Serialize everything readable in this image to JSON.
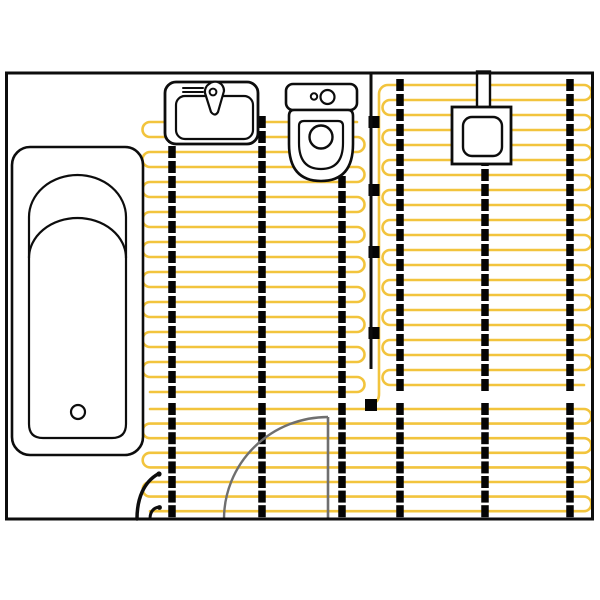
{
  "canvas": {
    "width": 600,
    "height": 600,
    "background": "#ffffff"
  },
  "colors": {
    "cable": "#F2C43D",
    "clip": "#050505",
    "outline": "#0d0d0d",
    "wall": "#0d0d0d",
    "door": "#6F6F6F",
    "fixture_fill": "#ffffff"
  },
  "room": {
    "x": 6.5,
    "y": 73,
    "w": 586,
    "h": 446,
    "stroke_width": 3
  },
  "heating": {
    "cable_stroke_width": 2.6,
    "zones": [
      {
        "name": "heating-zone-left",
        "x1": 150,
        "x2": 357,
        "y_top": 122,
        "spacing": 15,
        "rows": 19,
        "start_at_right": true,
        "prefix": ""
      },
      {
        "name": "heating-zone-right",
        "x1": 390,
        "x2": 584,
        "y_top": 85,
        "spacing": 15,
        "rows": 21,
        "start_at_right": false,
        "prefix": "M 372 404 Q 379 402 379 394 L 379 94 A 9 9 0 0 1 388 85"
      },
      {
        "name": "heating-zone-bottom",
        "x1": 150,
        "x2": 584,
        "y_top": 409,
        "spacing": 14.6,
        "rows": 8,
        "start_at_right": false,
        "prefix": ""
      }
    ],
    "strips": [
      {
        "x": 172,
        "zones": [
          "heating-zone-left",
          "heating-zone-bottom"
        ]
      },
      {
        "x": 262,
        "zones": [
          "heating-zone-left",
          "heating-zone-bottom"
        ]
      },
      {
        "x": 342,
        "zones": [
          "heating-zone-left",
          "heating-zone-bottom"
        ]
      },
      {
        "x": 400,
        "zones": [
          "heating-zone-right",
          "heating-zone-bottom"
        ]
      },
      {
        "x": 485,
        "zones": [
          "heating-zone-right",
          "heating-zone-bottom"
        ]
      },
      {
        "x": 570,
        "zones": [
          "heating-zone-right",
          "heating-zone-bottom"
        ]
      }
    ],
    "clip_size": {
      "w": 7.5,
      "h": 12
    },
    "feed_clips": {
      "x": 374,
      "w": 11,
      "h": 12,
      "ys": [
        122,
        190,
        252,
        333
      ]
    },
    "terminal": {
      "x": 365,
      "y": 399,
      "w": 12,
      "h": 12
    },
    "divider_line": {
      "x": 371,
      "y1": 73,
      "y2": 369,
      "stroke_width": 3
    },
    "leads": [
      {
        "name": "power-lead-main",
        "d": "M 137 519 C 137 498 144 482 158 474",
        "stroke_width": 3.5,
        "dot": {
          "cx": 159,
          "cy": 474,
          "r": 2.6
        }
      },
      {
        "name": "power-lead-small",
        "d": "M 150 519 C 150 512 153 508 159 507",
        "stroke_width": 3,
        "dot": {
          "cx": 159.5,
          "cy": 507.5,
          "r": 2.4
        }
      }
    ]
  },
  "fixtures": [
    {
      "name": "bathtub-outline",
      "type": "rect",
      "x": 12,
      "y": 147,
      "w": 131,
      "h": 308,
      "rx": 18,
      "sw": 2.6,
      "fill": true
    },
    {
      "name": "bathtub-basin",
      "type": "path",
      "d": "M 29 217 L 29 424 Q 29 438 43 438 L 112 438 Q 126 438 126 424 L 126 217 A 48.5 42 0 0 0 29 217 Z",
      "sw": 2.2,
      "fill": true
    },
    {
      "name": "bathtub-backrest-arc",
      "type": "path",
      "d": "M 29 258 A 48.5 40 0 0 1 126 258",
      "sw": 2.2,
      "fill": false
    },
    {
      "name": "bathtub-drain",
      "type": "circle",
      "cx": 78,
      "cy": 412,
      "r": 7,
      "sw": 2.2,
      "fill": true
    },
    {
      "name": "sink-outline",
      "type": "rect",
      "x": 165,
      "y": 82,
      "w": 93,
      "h": 62,
      "rx": 11,
      "sw": 2.8,
      "fill": true
    },
    {
      "name": "sink-basin",
      "type": "rect",
      "x": 176,
      "y": 96,
      "w": 77,
      "h": 43,
      "rx": 9,
      "sw": 2.2,
      "fill": true
    },
    {
      "name": "sink-vent-line",
      "type": "line",
      "x1": 183,
      "y1": 88,
      "x2": 203,
      "y2": 88,
      "sw": 2
    },
    {
      "name": "sink-vent-line",
      "type": "line",
      "x1": 183,
      "y1": 92,
      "x2": 203,
      "y2": 92,
      "sw": 2
    },
    {
      "name": "sink-vent-line",
      "type": "line",
      "x1": 183,
      "y1": 96,
      "x2": 203,
      "y2": 96,
      "sw": 2
    },
    {
      "name": "sink-faucet-body",
      "type": "path",
      "d": "M 209 84 A 9 9 0 0 1 224 91 L 218 112 Q 215 117 211 112 L 205 93 A 9 9 0 0 1 209 84 Z",
      "sw": 2.2,
      "fill": true
    },
    {
      "name": "sink-faucet-cap",
      "type": "circle",
      "cx": 213,
      "cy": 92,
      "r": 3.4,
      "sw": 2,
      "fill": true
    },
    {
      "name": "toilet-tank",
      "type": "rect",
      "x": 286,
      "y": 84,
      "w": 71,
      "h": 26,
      "rx": 7,
      "sw": 2.6,
      "fill": true
    },
    {
      "name": "toilet-button-small",
      "type": "circle",
      "cx": 314,
      "cy": 96.5,
      "r": 3.2,
      "sw": 2,
      "fill": true
    },
    {
      "name": "toilet-button-large",
      "type": "circle",
      "cx": 327.5,
      "cy": 97,
      "r": 7,
      "sw": 2.2,
      "fill": true
    },
    {
      "name": "toilet-bowl-outer",
      "type": "path",
      "d": "M 294 110 L 348 110 Q 353 110 353 116 L 353 144 Q 353 181 321 181 Q 289 181 289 144 L 289 116 Q 289 110 294 110 Z",
      "sw": 2.6,
      "fill": true
    },
    {
      "name": "toilet-bowl-inner",
      "type": "path",
      "d": "M 304 121 L 338 121 Q 343 121 343 126 L 343 143 Q 343 169 321 169 Q 299 169 299 143 L 299 126 Q 299 121 304 121 Z",
      "sw": 2.2,
      "fill": true
    },
    {
      "name": "toilet-flush-hole",
      "type": "circle",
      "cx": 321,
      "cy": 137,
      "r": 11.5,
      "sw": 2.4,
      "fill": true
    },
    {
      "name": "shower-supply-pipe",
      "type": "rect",
      "x": 477,
      "y": 71.5,
      "w": 13,
      "h": 38,
      "rx": 0,
      "sw": 2.4,
      "fill": true
    },
    {
      "name": "floor-drain-outer",
      "type": "rect",
      "x": 452,
      "y": 107,
      "w": 59,
      "h": 57,
      "rx": 0,
      "sw": 2.8,
      "fill": true
    },
    {
      "name": "floor-drain-inner",
      "type": "rect",
      "x": 463,
      "y": 117,
      "w": 39,
      "h": 39,
      "rx": 9,
      "sw": 2.4,
      "fill": true
    }
  ],
  "door": {
    "leaf": {
      "x1": 328,
      "y1": 417,
      "x2": 328,
      "y2": 519,
      "stroke_width": 2.6
    },
    "swing_arc": {
      "d": "M 224 519 A 104 102 0 0 1 328 417",
      "stroke_width": 2.4
    }
  }
}
